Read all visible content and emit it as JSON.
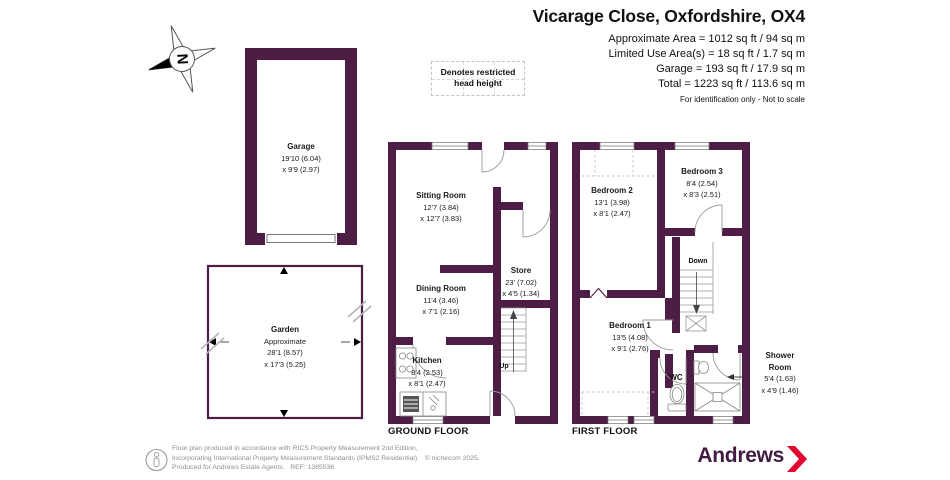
{
  "header": {
    "title": "Vicarage Close, Oxfordshire, OX4",
    "lines": [
      "Approximate Area = 1012 sq ft / 94 sq m",
      "Limited Use Area(s) = 18 sq ft / 1.7 sq m",
      "Garage = 193 sq ft / 17.9 sq m",
      "Total = 1223 sq ft / 113.6 sq m"
    ],
    "disclaimer": "For identification only - Not to scale"
  },
  "legend": {
    "line1": "Denotes restricted",
    "line2": "head height"
  },
  "compass": {
    "letter": "N"
  },
  "garage": {
    "name": "Garage",
    "dim1": "19'10 (6.04)",
    "dim2": "x 9'9 (2.97)"
  },
  "garden": {
    "name": "Garden",
    "approx": "Approximate",
    "dim1": "28'1 (8.57)",
    "dim2": "x 17'3 (5.25)"
  },
  "ground": {
    "label": "GROUND FLOOR",
    "sitting": {
      "name": "Sitting Room",
      "dim1": "12'7 (3.84)",
      "dim2": "x 12'7 (3.83)"
    },
    "store": {
      "name": "Store",
      "dim1": "23' (7.02)",
      "dim2": "x 4'5 (1.34)"
    },
    "dining": {
      "name": "Dining Room",
      "dim1": "11'4 (3.46)",
      "dim2": "x 7'1 (2.16)"
    },
    "kitchen": {
      "name": "Kitchen",
      "dim1": "8'4 (2.53)",
      "dim2": "x 8'1 (2.47)"
    },
    "up": "Up"
  },
  "first": {
    "label": "FIRST FLOOR",
    "bedroom2": {
      "name": "Bedroom 2",
      "dim1": "13'1 (3.98)",
      "dim2": "x 8'1 (2.47)"
    },
    "bedroom3": {
      "name": "Bedroom 3",
      "dim1": "8'4 (2.54)",
      "dim2": "x 8'3 (2.51)"
    },
    "bedroom1": {
      "name": "Bedroom 1",
      "dim1": "13'5 (4.08)",
      "dim2": "x 9'1 (2.76)"
    },
    "wc": "WC",
    "down": "Down",
    "shower": {
      "name1": "Shower",
      "name2": "Room",
      "dim1": "5'4 (1.63)",
      "dim2": "x 4'9 (1.46)"
    }
  },
  "footer": {
    "line1": "Floor plan produced in accordance with RICS Property Measurement 2nd Edition,",
    "line2": "Incorporating International Property Measurement Standards (IPMS2 Residential).   © nichecom 2025.",
    "line3": "Produced for Andrews Estate Agents.   REF: 1385536",
    "brand": "Andrews"
  },
  "colors": {
    "wall": "#4e1d45",
    "brand_purple": "#411c40",
    "chevron_red": "#e4032e"
  }
}
